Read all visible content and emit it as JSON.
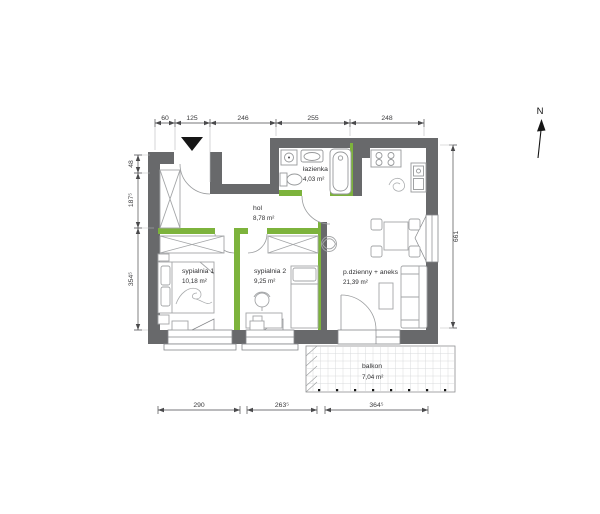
{
  "plan": {
    "north_label": "N",
    "rooms": [
      {
        "name": "łazienka",
        "area": "4,03 m²"
      },
      {
        "name": "hol",
        "area": "8,78 m²"
      },
      {
        "name": "sypialnia 1",
        "area": "10,18 m²"
      },
      {
        "name": "sypialnia 2",
        "area": "9,25 m²"
      },
      {
        "name": "p.dzienny + aneks",
        "area": "21,39 m²"
      },
      {
        "name": "balkon",
        "area": "7,04 m²"
      }
    ],
    "dimensions": {
      "top": [
        "60",
        "125",
        "246",
        "255",
        "248"
      ],
      "left": [
        "48",
        "187⁵",
        "354⁵"
      ],
      "right": [
        "661"
      ],
      "bottom": [
        "290",
        "263⁵",
        "364⁵"
      ]
    },
    "colors": {
      "wall": "#68696b",
      "partition": "#7db33c",
      "line": "#4a4a4c"
    }
  }
}
